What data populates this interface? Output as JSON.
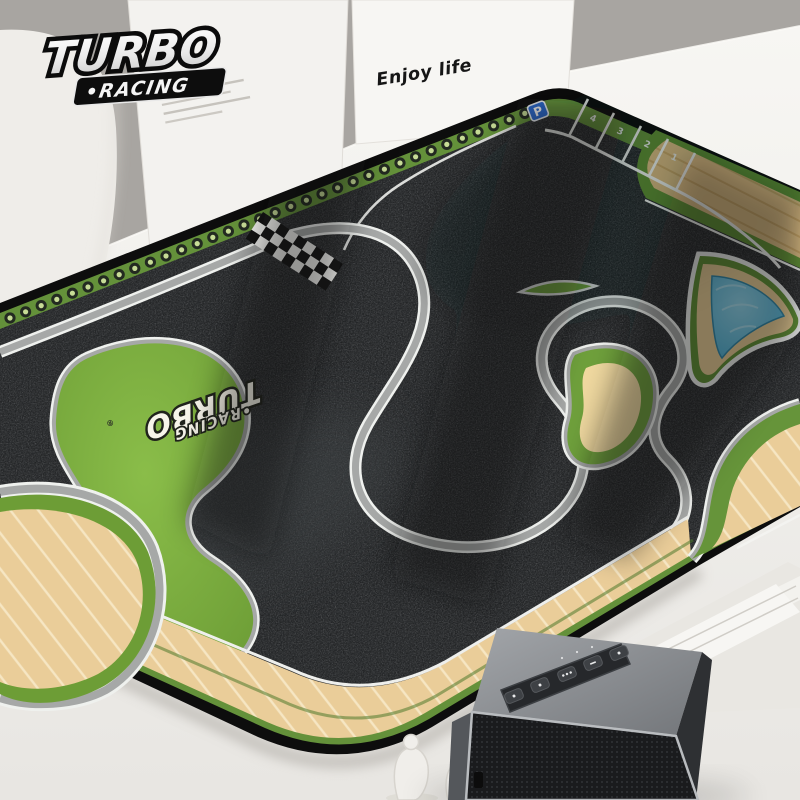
{
  "brand_logo": {
    "line1": "TURBO",
    "line2": "•RACING"
  },
  "background": {
    "box_text": "Enjoy life"
  },
  "mat": {
    "brand": {
      "line1": "TURBO",
      "line2": "•RACING",
      "registered": "®"
    },
    "parking": {
      "sign": "P",
      "numbers": [
        "4",
        "3",
        "2",
        "1"
      ]
    }
  },
  "speaker": {
    "buttons": [
      "power-button",
      "aux-button",
      "multi-function-button",
      "volume-down-button",
      "volume-up-button"
    ]
  },
  "colors": {
    "wall": "#a8a5a1",
    "desk": "#f2f1ed",
    "mat_edge": "#0d0d0d",
    "border_green": "#64913a",
    "asphalt": "#2b2d2f",
    "curb_gray": "#a6a8a7",
    "curb_white": "#eff1ee",
    "grass": "#7cb23e",
    "sand": "#eacd99",
    "wood": "#d9ba80",
    "pool_blue": "#49b4d8",
    "parking_sign_blue": "#2b6bd3",
    "checker_black": "#141414",
    "checker_white": "#f2f2ef",
    "speaker_body": "#85888c",
    "speaker_grille": "#1a1b1d"
  }
}
